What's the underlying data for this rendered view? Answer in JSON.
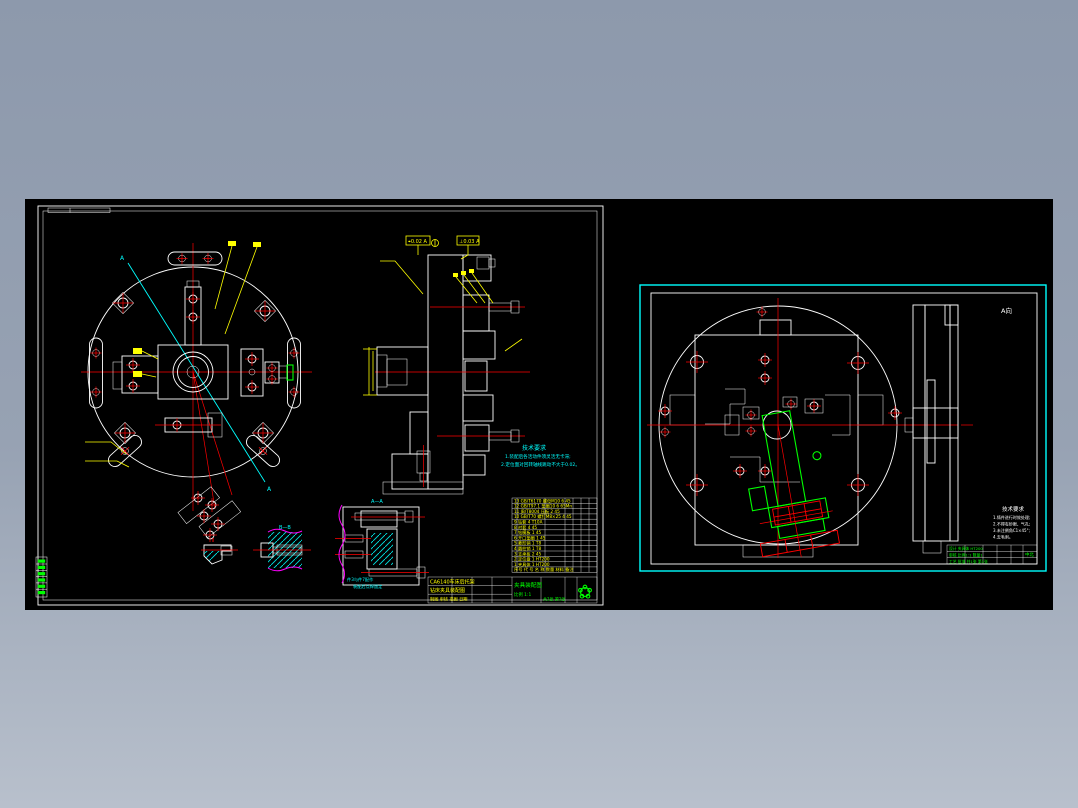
{
  "app": {
    "type": "cad-drawing-preview",
    "background_top": "#8d99ac",
    "background_bottom": "#b8c0cc",
    "canvas_color": "#000000"
  },
  "palette": {
    "line_white": "#ffffff",
    "centerline_red": "#ff0000",
    "dimension_yellow": "#ffff00",
    "hatch_cyan": "#00e5e5",
    "annotation_cyan": "#00ffff",
    "highlight_green": "#00ff00",
    "break_magenta": "#ff00ff"
  },
  "left_sheet": {
    "section_label_top": "A",
    "section_label_bottom": "A",
    "tolerance_box_left": "⌖0.02 A",
    "tolerance_box_right": "⊥0.03 A",
    "detail_label_small": "Ⅱ",
    "detail_label_mid": "B—B",
    "detail_label_right": "A—A",
    "notes_title": "技术要求",
    "notes_line1": "1.装配后各活动件须灵活无卡滞;",
    "notes_line2": "2.定位面对回转轴线跳动不大于0.02。",
    "detail_note1": "件3与件7配作",
    "detail_note2": "装配后点焊固定",
    "bom": {
      "rows": [
        "13 GB/T6170 螺母M10 6 45",
        "12 GB/T97.1 垫圈10 6 65Mn",
        "11 JB/T8004 压板 2 45",
        "10 GB/T70 螺钉M8×25 4 45",
        "9  钻套 4 T10A",
        "8  衬套 4 45",
        "7  钻模板 1 45",
        "6  开口垫圈 1 45",
        "5  菱形销 1 T8",
        "4  圆柱销 1 T8",
        "3  支承板 2 45",
        "2  定位盘 1 HT200",
        "1  夹具体 1 HT200",
        "序号 代 号  名 称 数量 材料 备注"
      ]
    },
    "title_block": {
      "row1": "CA6140车床后托架",
      "row2": "钻床夹具装配图",
      "row3": "制图  审核  描图  日期",
      "name": "夹具装配图",
      "scale": "比例 1:1",
      "sheet": "共1张 第1张"
    }
  },
  "right_sheet": {
    "view_label": "A向",
    "notes_title": "技术要求",
    "notes_lines": [
      "1.铸件进行时效处理;",
      "2.不得有砂眼、气孔;",
      "3.未注倒角C1×45°;",
      "4.去毛刺。"
    ],
    "title_block_rows": [
      "设计      夹具体  HT200",
      "审核      比例1:1  数量1",
      "工艺  批准  共1张 第1张"
    ],
    "title_block_stamp": "中北"
  }
}
